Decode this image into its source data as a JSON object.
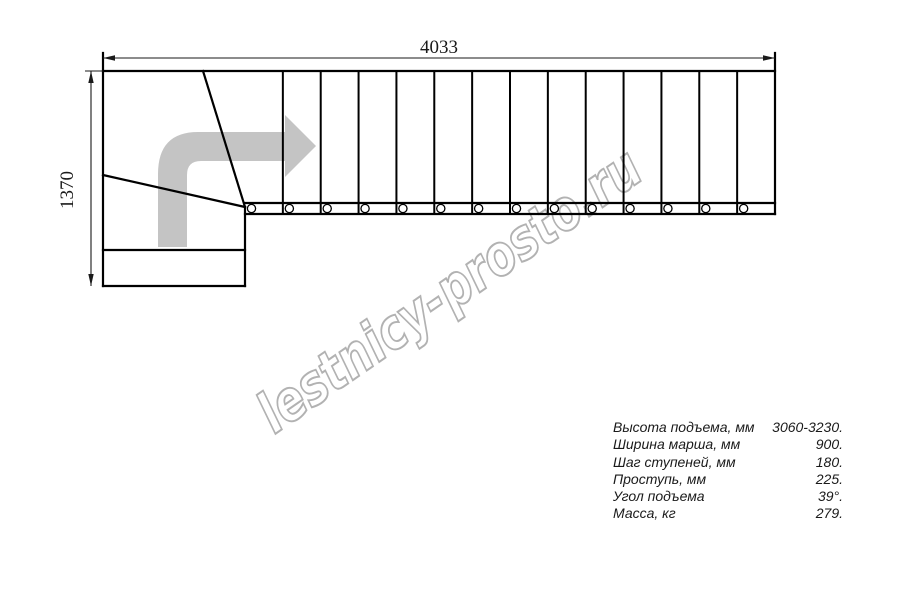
{
  "drawing_title": "L-shaped staircase plan",
  "dimensions": {
    "total_length": "4033",
    "total_width": "1370"
  },
  "watermark": {
    "text": "lestnicy-prosto.ru"
  },
  "plan": {
    "straight_treads": 14,
    "winder_treads": 3,
    "balusters": 14
  },
  "specs": {
    "rows": [
      {
        "label": "Высота подъема, мм",
        "value": "3060-3230."
      },
      {
        "label": "Ширина марша, мм",
        "value": "900."
      },
      {
        "label": "Шаг ступеней, мм",
        "value": "180."
      },
      {
        "label": "Проступь, мм",
        "value": "225."
      },
      {
        "label": "Угол подъема",
        "value": "39°."
      },
      {
        "label": "Масса, кг",
        "value": "279."
      }
    ]
  },
  "colors": {
    "line": "#000000",
    "dim_line": "#1a1a1a",
    "arrow_fill": "#c4c4c4",
    "watermark_stroke": "#b2b2b2",
    "background": "#ffffff"
  }
}
